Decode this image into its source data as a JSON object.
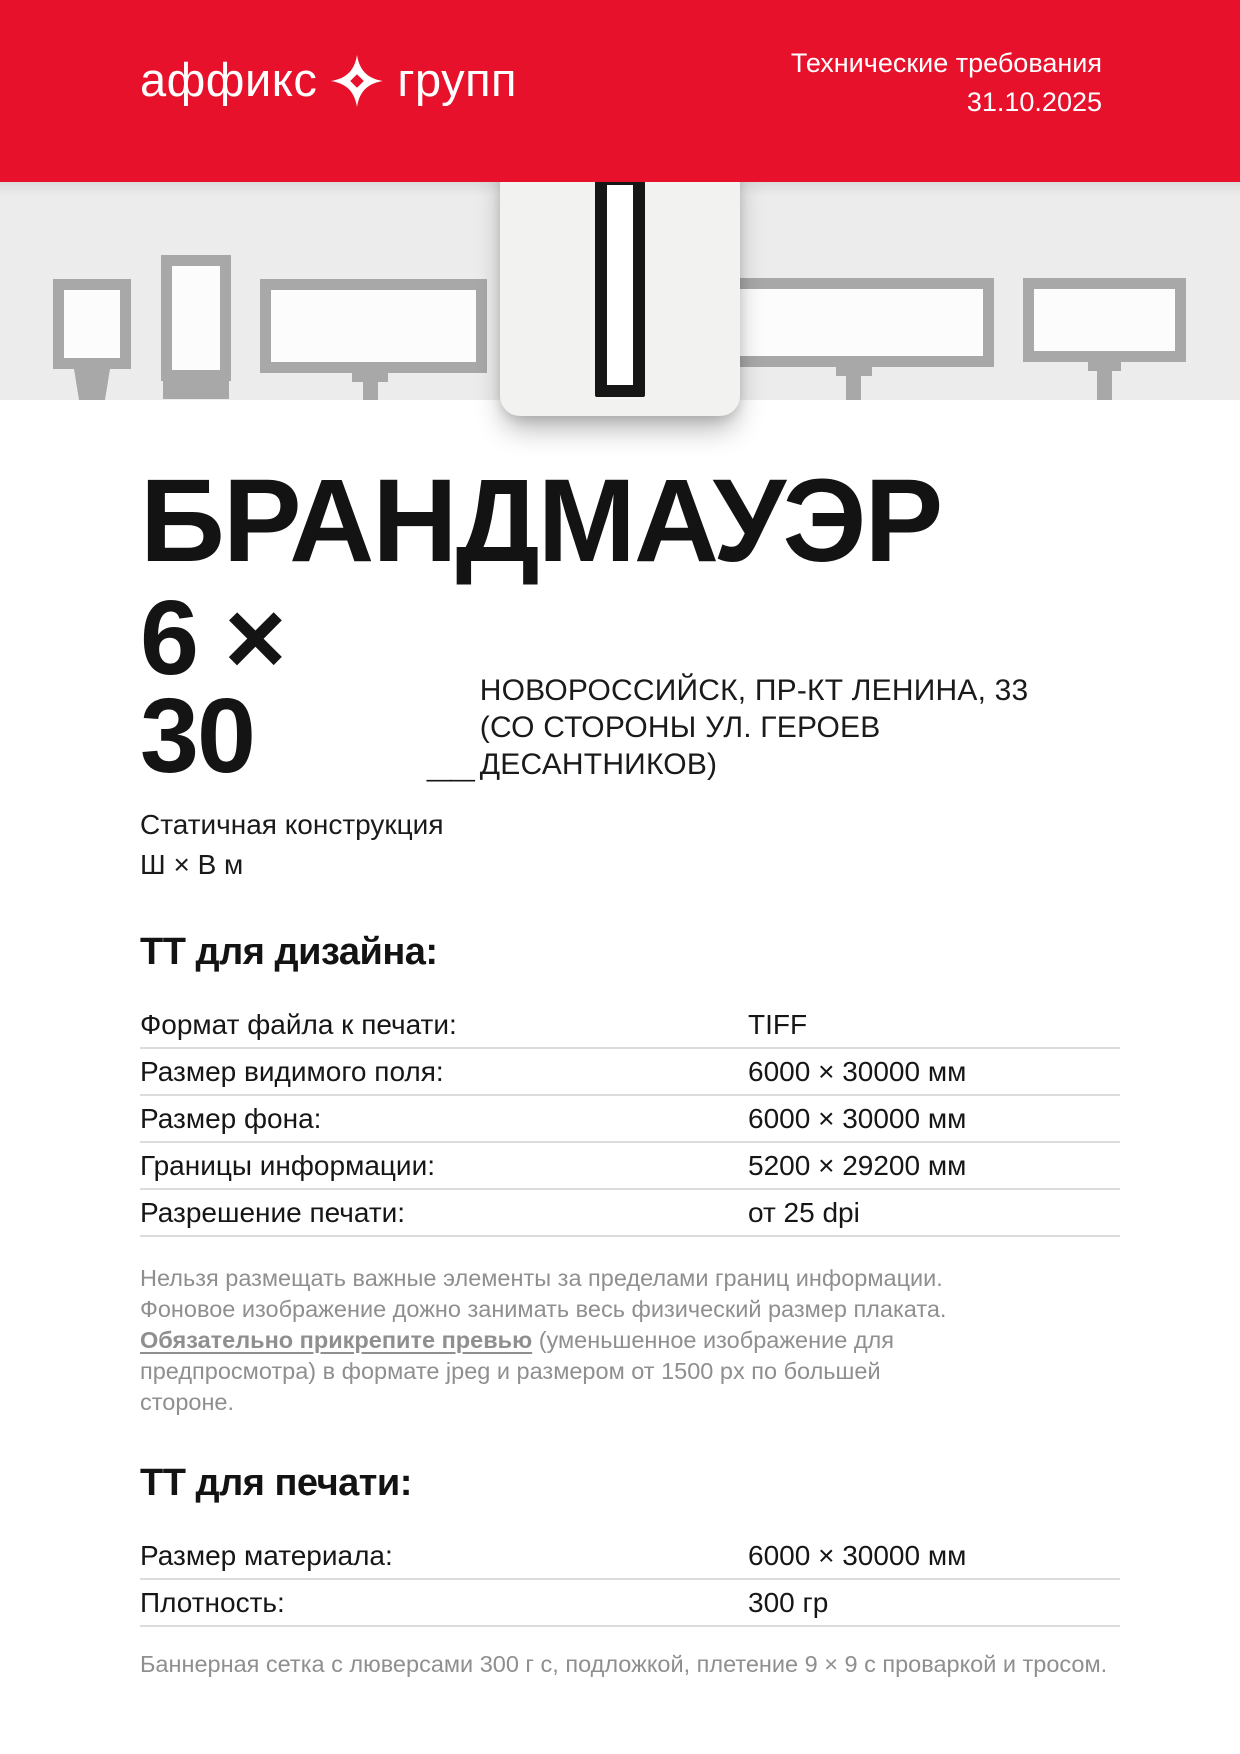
{
  "colors": {
    "brand_red": "#e8112c",
    "ink": "#141414",
    "muted_gray": "#8f8f8f",
    "band_gray": "#ececec",
    "frame_gray": "#a8a8a8",
    "table_line": "#dcdcdc"
  },
  "header": {
    "logo_part1": "аффикс",
    "logo_part2": "групп",
    "logo_symbol": "sparkle-star-icon",
    "doc_type": "Технические требования",
    "date": "31.10.2025"
  },
  "hero": {
    "title": "БРАНДМАУЭР",
    "size": "6 × 30",
    "size_underscore": "__",
    "address_line1": "НОВОРОССИЙСК, ПР-КТ ЛЕНИНА, 33",
    "address_line2": "(СО СТОРОНЫ УЛ. ГЕРОЕВ ДЕСАНТНИКОВ)",
    "construction_type": "Статичная конструкция",
    "dimensions_legend": "Ш × В м"
  },
  "design_section": {
    "heading": "ТТ для дизайна:",
    "rows": [
      {
        "label": "Формат файла к печати:",
        "value": "TIFF"
      },
      {
        "label": "Размер видимого поля:",
        "value": "6000 × 30000 мм"
      },
      {
        "label": "Размер фона:",
        "value": "6000 × 30000 мм"
      },
      {
        "label": "Границы информации:",
        "value": "5200 × 29200 мм"
      },
      {
        "label": "Разрешение печати:",
        "value": "от 25 dpi"
      }
    ],
    "note_part1": "Нельзя размещать важные элементы за пределами границ информации.\nФоновое изображение дожно занимать весь физический размер плаката.\n",
    "note_bold": "Обязательно прикрепите превью",
    "note_part2": " (уменьшенное изображение для предпросмотра) в формате jpeg и размером от 1500 px по большей стороне."
  },
  "print_section": {
    "heading": "ТТ для печати:",
    "rows": [
      {
        "label": "Размер материала:",
        "value": "6000 × 30000 мм"
      },
      {
        "label": "Плотность:",
        "value": "300 гр"
      }
    ],
    "note": "Баннерная сетка с люверсами 300 г с, подложкой, плетение 9 × 9 с проваркой и тросом."
  }
}
